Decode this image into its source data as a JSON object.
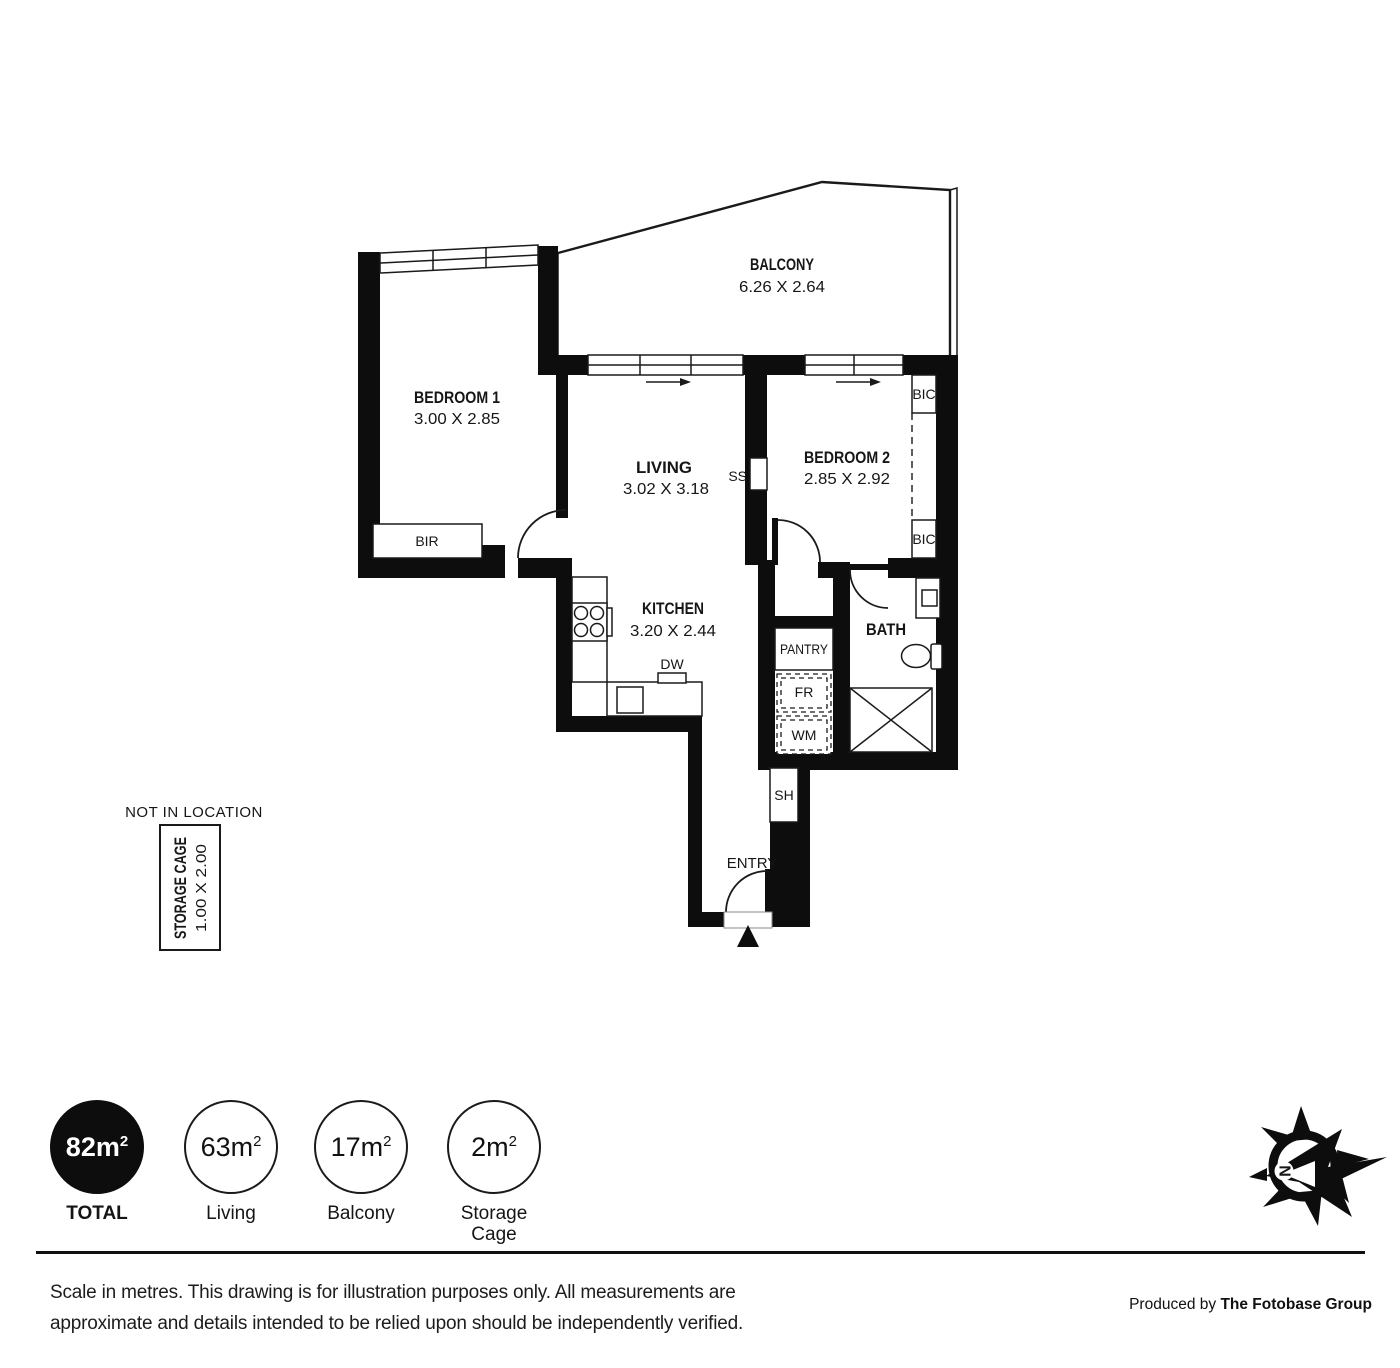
{
  "colors": {
    "wall": "#0d0d0d",
    "line": "#1a1a1a",
    "background": "#ffffff"
  },
  "plan": {
    "balcony": {
      "name": "BALCONY",
      "dims": "6.26 X 2.64"
    },
    "bedroom1": {
      "name": "BEDROOM 1",
      "dims": "3.00 X 2.85"
    },
    "living": {
      "name": "LIVING",
      "dims": "3.02 X 3.18"
    },
    "bedroom2": {
      "name": "BEDROOM 2",
      "dims": "2.85 X 2.92"
    },
    "kitchen": {
      "name": "KITCHEN",
      "dims": "3.20 X 2.44"
    },
    "bath": {
      "name": "BATH"
    },
    "labels": {
      "bir": "BIR",
      "bic_top": "BIC",
      "bic_bottom": "BIC",
      "ss": "SS",
      "dw": "DW",
      "pantry": "PANTRY",
      "fr": "FR",
      "wm": "WM",
      "sh": "SH",
      "entry": "ENTRY"
    }
  },
  "storage_cage": {
    "note": "NOT IN LOCATION",
    "name": "STORAGE CAGE",
    "dims": "1.00 X 2.00"
  },
  "compass": {
    "north_label": "N"
  },
  "legend": {
    "items": [
      {
        "value": "82m",
        "sup": "2",
        "label": "TOTAL",
        "filled": true
      },
      {
        "value": "63m",
        "sup": "2",
        "label": "Living",
        "filled": false
      },
      {
        "value": "17m",
        "sup": "2",
        "label": "Balcony",
        "filled": false
      },
      {
        "value": "2m",
        "sup": "2",
        "label": "Storage Cage",
        "filled": false
      }
    ]
  },
  "footer": {
    "disclaimer_line1": "Scale in metres. This drawing is for illustration purposes only. All measurements are",
    "disclaimer_line2": "approximate and details intended to be relied upon should be independently verified.",
    "credit_prefix": "Produced by ",
    "credit_name": "The Fotobase Group"
  }
}
